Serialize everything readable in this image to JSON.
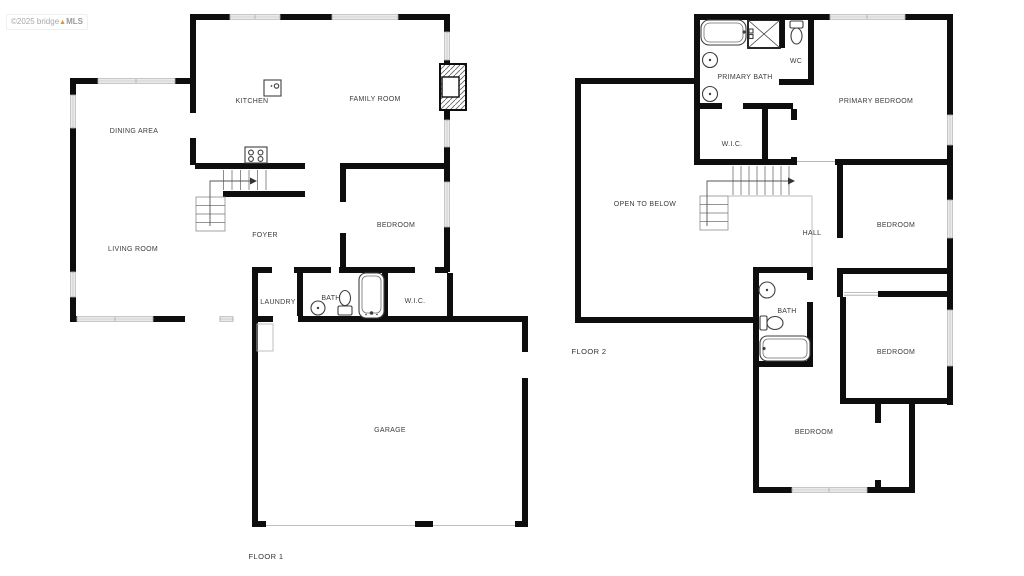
{
  "watermark": {
    "copyright": "©2025 bridge",
    "logo_glyph": "▲",
    "brand": "MLS"
  },
  "floor1": {
    "title": "FLOOR 1",
    "rooms": {
      "dining_area": "DINING AREA",
      "kitchen": "KITCHEN",
      "family_room": "FAMILY ROOM",
      "living_room": "LIVING ROOM",
      "foyer": "FOYER",
      "bedroom": "BEDROOM",
      "laundry": "LAUNDRY",
      "bath": "BATH",
      "wic": "W.I.C.",
      "garage": "GARAGE"
    },
    "fixture_icons": [
      "kitchen-island-icon",
      "stove-icon",
      "fireplace-icon",
      "stairs-icon",
      "sink-icon",
      "toilet-icon",
      "bathtub-icon",
      "garage-door-icon"
    ]
  },
  "floor2": {
    "title": "FLOOR 2",
    "rooms": {
      "primary_bath": "PRIMARY BATH",
      "wc": "WC",
      "primary_bedroom": "PRIMARY BEDROOM",
      "wic": "W.I.C.",
      "open_to_below": "OPEN TO BELOW",
      "hall": "HALL",
      "bedroom_upper_right": "BEDROOM",
      "bedroom_lower_right": "BEDROOM",
      "bedroom_bottom": "BEDROOM",
      "bath": "BATH"
    },
    "fixture_icons": [
      "bathtub-icon",
      "shower-icon",
      "toilet-icon",
      "sink-icon",
      "stairs-icon"
    ]
  },
  "colors": {
    "wall": "#0e0e0e",
    "window_line": "#a9a9a9",
    "thin_line": "#b8b8b8",
    "stair_line": "#707070",
    "label_text": "#3c3c3c",
    "watermark_text": "#a8a8a8",
    "watermark_accent": "#e8932a",
    "background": "#ffffff"
  }
}
